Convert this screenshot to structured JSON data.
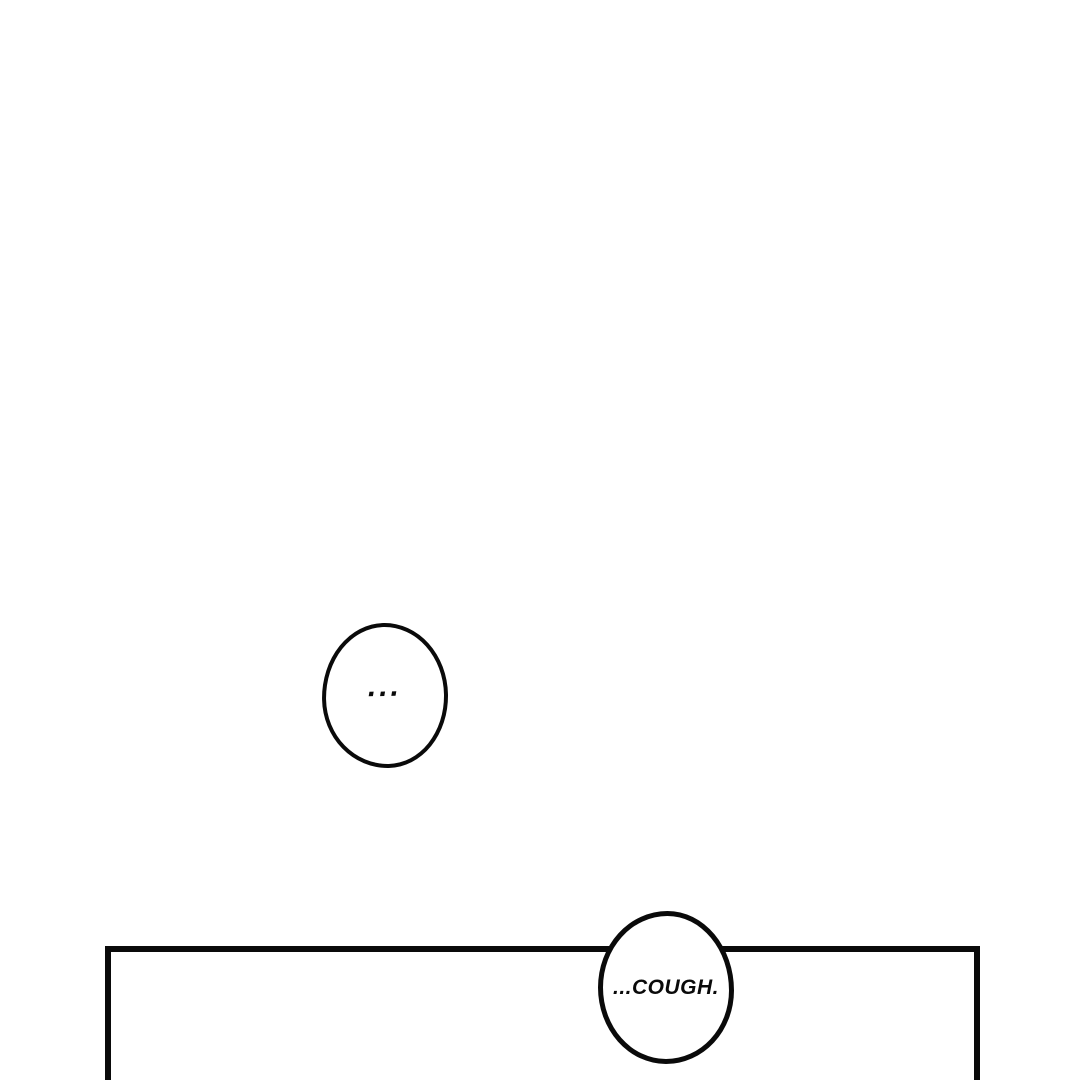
{
  "page": {
    "kind": "comic-panel-page",
    "colors": {
      "paper": "#ffffff",
      "ink": "#0a0a0a"
    }
  },
  "bubbles": {
    "ellipsis": {
      "text": "..."
    },
    "cough": {
      "text": "...COUGH."
    }
  }
}
